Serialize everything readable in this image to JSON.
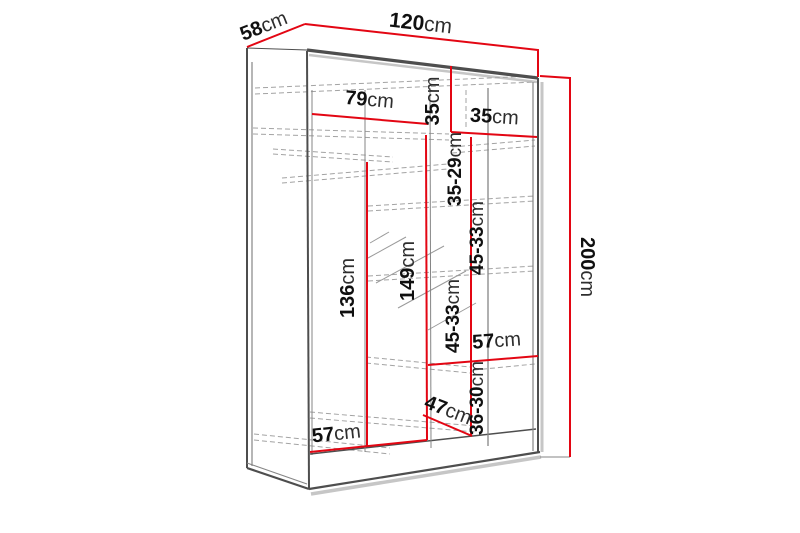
{
  "diagram": {
    "type": "furniture-dimension-drawing",
    "subject": "sliding-door wardrobe with shelves and hanging rail"
  },
  "colors": {
    "dimension_accent": "#e30613",
    "outline": "#4e4e4e",
    "hidden_lines": "#a3a3a3",
    "background": "#ffffff"
  },
  "dims": {
    "depth": {
      "value": "58",
      "unit": "cm"
    },
    "width": {
      "value": "120",
      "unit": "cm"
    },
    "height": {
      "value": "200",
      "unit": "cm"
    },
    "left_compartment_width": {
      "value": "79",
      "unit": "cm"
    },
    "top_compartment_height": {
      "value": "35",
      "unit": "cm"
    },
    "shelf_column_width": {
      "value": "35",
      "unit": "cm"
    },
    "shelf_spacing_top": {
      "value": "35-29",
      "unit": "cm"
    },
    "shelf_spacing_middle": {
      "value": "45-33",
      "unit": "cm"
    },
    "shelf_spacing_lower": {
      "value": "45-33",
      "unit": "cm"
    },
    "left_interior_height": {
      "value": "136",
      "unit": "cm"
    },
    "middle_interior_height": {
      "value": "149",
      "unit": "cm"
    },
    "shoe_shelf_width": {
      "value": "57",
      "unit": "cm"
    },
    "bottom_compartment_height": {
      "value": "36-30",
      "unit": "cm"
    },
    "bottom_compartment_depth": {
      "value": "47",
      "unit": "cm"
    },
    "bottom_interior_width": {
      "value": "57",
      "unit": "cm"
    }
  }
}
